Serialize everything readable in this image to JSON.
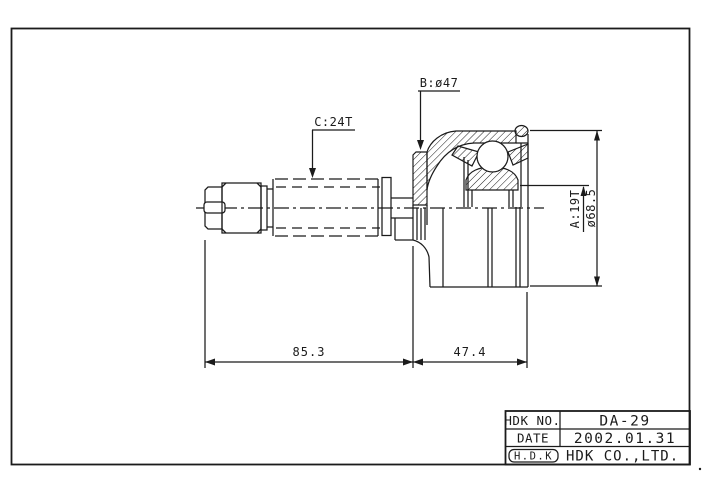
{
  "colors": {
    "ink": "#1b1b1b",
    "paper": "#ffffff"
  },
  "dimensions": {
    "shaft_spline": "C:24T",
    "boot_groove_diameter": "B:ø47",
    "inner_spline": "A:19T",
    "outer_diameter": "ø68.5",
    "shaft_length": "85.3",
    "joint_length": "47.4"
  },
  "title_block": {
    "part_no_label": "HDK NO.",
    "part_no": "DA-29",
    "date_label": "DATE",
    "date": "2002.01.31",
    "logo": "H.D.K",
    "company": "HDK CO.,LTD."
  }
}
